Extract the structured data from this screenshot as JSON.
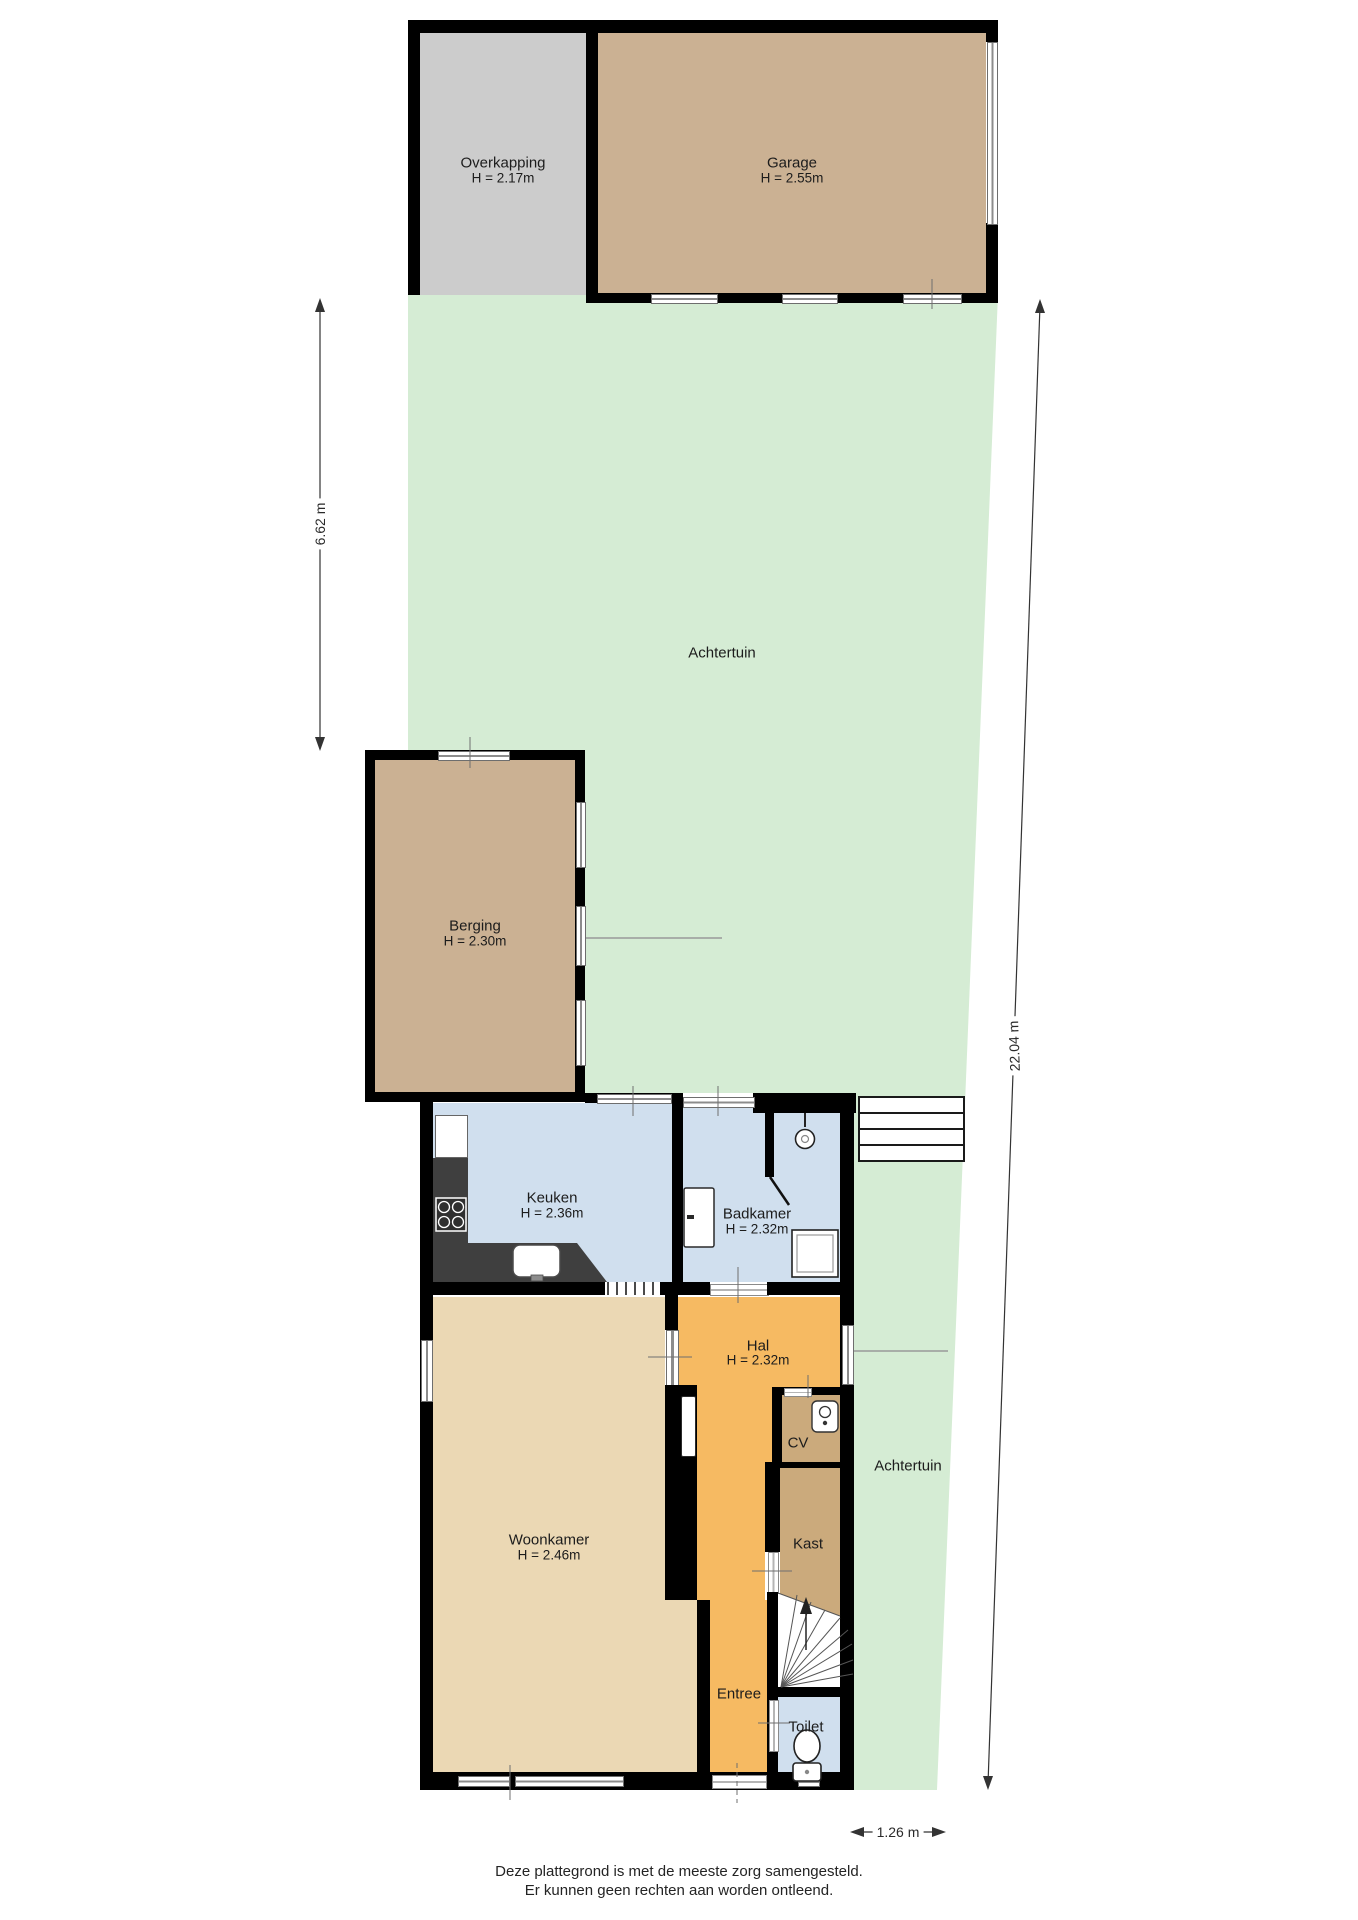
{
  "title": "Plattegrond begane grond met tuin",
  "rooms": {
    "overkapping": {
      "name": "Overkapping",
      "height": "H = 2.17m"
    },
    "garage": {
      "name": "Garage",
      "height": "H = 2.55m"
    },
    "achtertuin_upper": {
      "name": "Achtertuin"
    },
    "achtertuin_lower": {
      "name": "Achtertuin"
    },
    "berging": {
      "name": "Berging",
      "height": "H = 2.30m"
    },
    "keuken": {
      "name": "Keuken",
      "height": "H = 2.36m"
    },
    "badkamer": {
      "name": "Badkamer",
      "height": "H = 2.32m"
    },
    "hal": {
      "name": "Hal",
      "height": "H = 2.32m"
    },
    "cv": {
      "name": "CV"
    },
    "kast": {
      "name": "Kast"
    },
    "woonkamer": {
      "name": "Woonkamer",
      "height": "H = 2.46m"
    },
    "entree": {
      "name": "Entree"
    },
    "toilet": {
      "name": "Toilet"
    }
  },
  "dimensions": {
    "left_vertical": "6.62 m",
    "right_vertical": "22.04 m",
    "bottom_horizontal": "1.26 m"
  },
  "footer": {
    "line1": "Deze plattegrond is met de meeste zorg samengesteld.",
    "line2": "Er kunnen geen rechten aan worden ontleend."
  },
  "colors": {
    "wall": "#000000",
    "garden": "#d5ecd4",
    "overkapping_floor": "#cccccc",
    "garage_floor": "#cbb193",
    "berging_floor": "#cbb193",
    "keuken_floor": "#d0dfee",
    "badkamer_floor": "#d0dfee",
    "toilet_floor": "#d0dfee",
    "hal_floor": "#f6ba62",
    "entree_floor": "#f6ba62",
    "cv_floor": "#cbaa7c",
    "kast_floor": "#cbaa7c",
    "woonkamer_floor": "#ebd8b4",
    "counter": "#3f3f3f"
  }
}
